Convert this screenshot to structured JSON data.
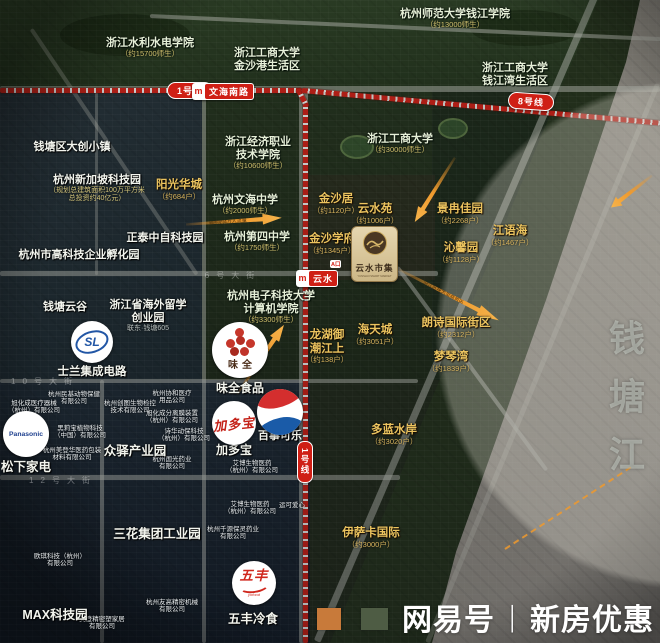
{
  "watermark": {
    "brand": "网易号",
    "divider": "丨",
    "text": "新房优惠"
  },
  "metro": {
    "line1_badge": "1号线",
    "line8_badge": "8号线",
    "line1_vertical_badge": "1号线",
    "station_wenhai": "文海南路",
    "station_yunshui": "云水",
    "metro_glyph": "m",
    "line_color": "#c92118"
  },
  "project": {
    "name": "云水市集",
    "name_en": "YUNSHUI SMART MARKET",
    "exit_label": "A口"
  },
  "logos": {
    "panasonic": "Panasonic",
    "sl": "SL",
    "jdb": "加多宝",
    "weiquan": "味全",
    "wufeng": "五丰",
    "wufeng_sub": "yofood"
  },
  "river": {
    "name": "钱塘江"
  },
  "map": {
    "labels": [
      {
        "id": "school-hangshida-qianjiang",
        "type": "school",
        "x": 455,
        "y": 8,
        "lines": [
          "杭州师范大学钱江学院"
        ],
        "sub": "（约13000师生）"
      },
      {
        "id": "school-shuili-shuidian",
        "type": "school",
        "x": 150,
        "y": 37,
        "lines": [
          "浙江水利水电学院"
        ],
        "sub": "（约15700师生）"
      },
      {
        "id": "school-gongshang-jinshagang",
        "type": "school",
        "x": 267,
        "y": 47,
        "lines": [
          "浙江工商大学",
          "金沙港生活区"
        ]
      },
      {
        "id": "school-gongshang-qianjiangwan",
        "type": "school",
        "x": 515,
        "y": 62,
        "lines": [
          "浙江工商大学",
          "钱江湾生活区"
        ]
      },
      {
        "id": "school-jingji-zhiye",
        "type": "school",
        "x": 258,
        "y": 136,
        "lines": [
          "浙江经济职业",
          "技术学院"
        ],
        "sub": "（约10600师生）"
      },
      {
        "id": "school-gongshang",
        "type": "school",
        "x": 400,
        "y": 133,
        "lines": [
          "浙江工商大学"
        ],
        "sub": "（约30000师生）"
      },
      {
        "id": "school-wenhai-middle",
        "type": "school",
        "x": 245,
        "y": 194,
        "lines": [
          "杭州文海中学"
        ],
        "sub": "（约2000师生）"
      },
      {
        "id": "school-no4-middle",
        "type": "school",
        "x": 257,
        "y": 231,
        "lines": [
          "杭州第四中学"
        ],
        "sub": "（约1750师生）"
      },
      {
        "id": "school-hdu-jisuanji",
        "type": "school",
        "x": 271,
        "y": 290,
        "lines": [
          "杭州电子科技大学",
          "计算机学院"
        ],
        "sub": "（约3300师生）"
      },
      {
        "id": "park-dachuang-town",
        "type": "park",
        "x": 72,
        "y": 141,
        "lines": [
          "钱塘区大创小镇"
        ]
      },
      {
        "id": "park-xinjiapo",
        "type": "park",
        "x": 97,
        "y": 174,
        "lines": [
          "杭州新加坡科技园"
        ],
        "sub": "（规划总建筑面积100万平方米",
        "sub2": "总投资约40亿元）"
      },
      {
        "id": "park-zhengtai",
        "type": "park",
        "x": 165,
        "y": 232,
        "lines": [
          "正泰中自科技园"
        ]
      },
      {
        "id": "park-fuhuayuan",
        "type": "park",
        "x": 79,
        "y": 249,
        "lines": [
          "杭州市高科技企业孵化园"
        ]
      },
      {
        "id": "park-qiantang-yungu",
        "type": "park",
        "x": 65,
        "y": 301,
        "lines": [
          "钱塘云谷"
        ]
      },
      {
        "id": "park-haiwai-liuxue",
        "type": "park",
        "x": 148,
        "y": 299,
        "lines": [
          "浙江省海外留学",
          "创业园"
        ],
        "sub": "联东·钱塘605",
        "subGray": true
      },
      {
        "id": "park-zhongyi",
        "type": "park",
        "x": 135,
        "y": 444,
        "size": 12.5,
        "lines": [
          "众驿产业园"
        ]
      },
      {
        "id": "park-sanhua",
        "type": "park",
        "x": 157,
        "y": 527,
        "size": 12.5,
        "lines": [
          "三花集团工业园"
        ]
      },
      {
        "id": "park-max",
        "type": "park",
        "x": 55,
        "y": 608,
        "size": 12.5,
        "lines": [
          "MAX科技园"
        ]
      },
      {
        "id": "label-songxia",
        "type": "park",
        "x": 26,
        "y": 460,
        "size": 12.5,
        "lines": [
          "松下家电"
        ]
      },
      {
        "id": "label-jdb",
        "type": "park",
        "x": 234,
        "y": 443,
        "size": 12,
        "lines": [
          "加多宝"
        ]
      },
      {
        "id": "label-pepsi",
        "type": "park",
        "x": 280,
        "y": 430,
        "size": 11,
        "lines": [
          "百事可乐"
        ]
      },
      {
        "id": "label-weiquan",
        "type": "park",
        "x": 240,
        "y": 381,
        "size": 12,
        "lines": [
          "味全食品"
        ]
      },
      {
        "id": "label-silan",
        "type": "park",
        "x": 92,
        "y": 366,
        "size": 11.5,
        "lines": [
          "士兰集成电路"
        ]
      },
      {
        "id": "label-wufeng",
        "type": "park",
        "x": 253,
        "y": 612,
        "size": 12.5,
        "lines": [
          "五丰冷食"
        ]
      },
      {
        "id": "res-yangguang-huacheng",
        "type": "res",
        "x": 179,
        "y": 179,
        "lines": [
          "阳光华城"
        ],
        "sub": "（约684户）"
      },
      {
        "id": "res-jinshaju",
        "type": "res",
        "x": 336,
        "y": 193,
        "lines": [
          "金沙居"
        ],
        "sub": "（约1120户）"
      },
      {
        "id": "res-yunshuiyuan",
        "type": "res",
        "x": 375,
        "y": 203,
        "lines": [
          "云水苑"
        ],
        "sub": "（约1006户）"
      },
      {
        "id": "res-jinsha-xuefu",
        "type": "res",
        "x": 332,
        "y": 233,
        "lines": [
          "金沙学府"
        ],
        "sub": "（约1345户）"
      },
      {
        "id": "res-jingran-jiayuan",
        "type": "res",
        "x": 460,
        "y": 203,
        "lines": [
          "景冉佳园"
        ],
        "sub": "（约2268户）"
      },
      {
        "id": "res-jiangyuhai",
        "type": "res",
        "x": 510,
        "y": 225,
        "lines": [
          "江语海"
        ],
        "sub": "（约1467户）"
      },
      {
        "id": "res-qinxinyuan",
        "type": "res",
        "x": 461,
        "y": 242,
        "lines": [
          "沁馨园"
        ],
        "sub": "（约1128户）"
      },
      {
        "id": "res-longhu-yuchaojiangshang",
        "type": "res",
        "x": 327,
        "y": 329,
        "lines": [
          "龙湖御",
          "潮江上"
        ],
        "sub": "（约138户）"
      },
      {
        "id": "res-haitiancheng",
        "type": "res",
        "x": 375,
        "y": 324,
        "lines": [
          "海天城"
        ],
        "sub": "（约3051户）"
      },
      {
        "id": "res-langshi-guoji",
        "type": "res",
        "x": 456,
        "y": 317,
        "lines": [
          "朗诗国际街区"
        ],
        "sub": "（约2312户）"
      },
      {
        "id": "res-mengqinwan",
        "type": "res",
        "x": 451,
        "y": 351,
        "lines": [
          "梦琴湾"
        ],
        "sub": "（约1839户）"
      },
      {
        "id": "res-duolan-shuian",
        "type": "res",
        "x": 394,
        "y": 424,
        "lines": [
          "多蓝水岸"
        ],
        "sub": "（约3020户）"
      },
      {
        "id": "res-yisaka-guoji",
        "type": "res",
        "x": 371,
        "y": 527,
        "lines": [
          "伊萨卡国际"
        ],
        "sub": "（约3000户）"
      },
      {
        "id": "co-minji",
        "type": "micro",
        "x": 74,
        "y": 391,
        "lines": [
          "杭州民基动物保健",
          "有限公司"
        ]
      },
      {
        "id": "co-xuhuacheng-yiliao",
        "type": "micro",
        "x": 34,
        "y": 400,
        "lines": [
          "旭化成医疗器械",
          "（杭州）有限公司"
        ]
      },
      {
        "id": "co-heilibao",
        "type": "micro",
        "x": 80,
        "y": 425,
        "lines": [
          "黑莉宝植物科技",
          "（中国）有限公司"
        ]
      },
      {
        "id": "co-meidenghua",
        "type": "micro",
        "x": 72,
        "y": 447,
        "lines": [
          "杭州美登华医药包装",
          "材料有限公司"
        ]
      },
      {
        "id": "co-chuangtu",
        "type": "micro",
        "x": 130,
        "y": 400,
        "lines": [
          "杭州创图生物检控",
          "技术有限公司"
        ]
      },
      {
        "id": "co-xiehe",
        "type": "micro",
        "x": 172,
        "y": 390,
        "lines": [
          "杭州协和医疗",
          "用品公司"
        ]
      },
      {
        "id": "co-xuhuacheng-fenli",
        "type": "micro",
        "x": 172,
        "y": 410,
        "lines": [
          "旭化成分离膜装置",
          "（杭州）有限公司"
        ]
      },
      {
        "id": "co-shihua",
        "type": "micro",
        "x": 184,
        "y": 428,
        "lines": [
          "诗华动保科技",
          "（杭州）有限公司"
        ]
      },
      {
        "id": "co-guoguang",
        "type": "micro",
        "x": 172,
        "y": 456,
        "lines": [
          "杭州国光药业",
          "有限公司"
        ]
      },
      {
        "id": "co-aibo-1",
        "type": "micro",
        "x": 252,
        "y": 460,
        "lines": [
          "艾博生物医药",
          "（杭州）有限公司"
        ]
      },
      {
        "id": "co-aibo-2",
        "type": "micro",
        "x": 250,
        "y": 501,
        "lines": [
          "艾博生物医药",
          "（杭州）有限公司"
        ]
      },
      {
        "id": "co-yunke",
        "type": "micro",
        "x": 292,
        "y": 502,
        "lines": [
          "运可爱心"
        ]
      },
      {
        "id": "co-qianyuan-baoling",
        "type": "micro",
        "x": 233,
        "y": 526,
        "lines": [
          "杭州千源保灵药业",
          "有限公司"
        ]
      },
      {
        "id": "co-ouqi",
        "type": "micro",
        "x": 60,
        "y": 553,
        "lines": [
          "欧琪科技（杭州）",
          "有限公司"
        ]
      },
      {
        "id": "co-yougao",
        "type": "micro",
        "x": 172,
        "y": 599,
        "lines": [
          "杭州友高精密机械",
          "有限公司"
        ]
      },
      {
        "id": "co-meideng-sujia",
        "type": "micro",
        "x": 102,
        "y": 616,
        "lines": [
          "美登精密塑家居",
          "有限公司"
        ]
      },
      {
        "id": "road-6th-street",
        "type": "roadname",
        "x": 233,
        "y": 271,
        "lines": [
          "6号大街"
        ]
      },
      {
        "id": "road-12th-street",
        "type": "roadname",
        "x": 63,
        "y": 476,
        "lines": [
          "12号大街"
        ]
      },
      {
        "id": "road-10th-street",
        "type": "roadname",
        "x": 45,
        "y": 377,
        "lines": [
          "10号大街"
        ]
      },
      {
        "id": "river-char-qian",
        "type": "river",
        "x": 627,
        "y": 318,
        "lines": [
          "钱"
        ]
      },
      {
        "id": "river-char-tang",
        "type": "river",
        "x": 627,
        "y": 376,
        "lines": [
          "塘"
        ]
      },
      {
        "id": "river-char-jiang",
        "type": "river",
        "x": 627,
        "y": 434,
        "lines": [
          "江"
        ]
      }
    ],
    "arrows": [
      {
        "id": "arrow-flow-center",
        "x": 186,
        "y": 219,
        "w": 96,
        "rot": -4,
        "text": "辐射约4万人流量"
      },
      {
        "id": "arrow-banner-riverside",
        "x": 399,
        "y": 264,
        "w": 112,
        "rot": 27,
        "text": "沿江区块大型商贸区"
      },
      {
        "id": "arrow-weiquan-market",
        "x": 237,
        "y": 389,
        "w": 84,
        "rot": -56,
        "text": "人流导入云水市集"
      },
      {
        "id": "arrow-top-right",
        "x": 652,
        "y": 170,
        "w": 52,
        "rot": 142,
        "text": ""
      },
      {
        "id": "arrow-jingran",
        "x": 455,
        "y": 152,
        "w": 76,
        "rot": 122,
        "text": ""
      }
    ]
  }
}
